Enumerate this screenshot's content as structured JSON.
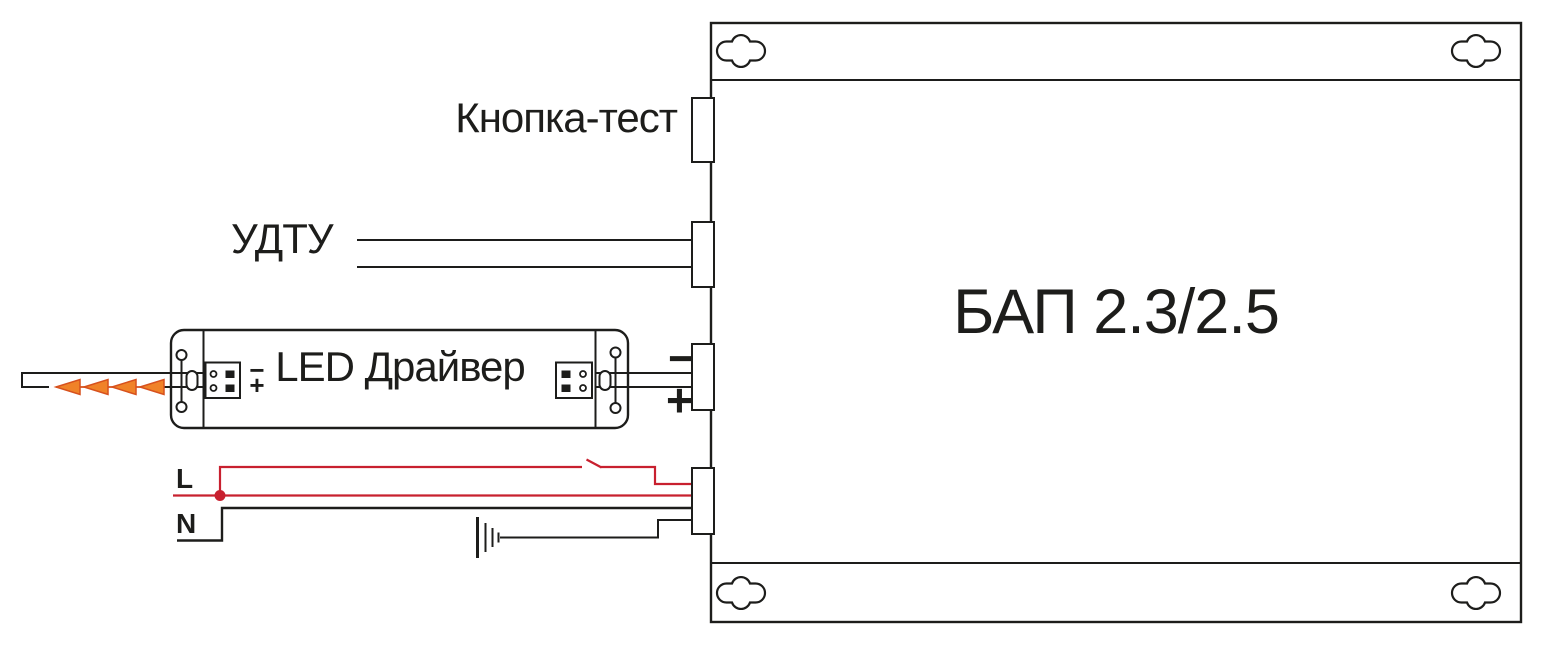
{
  "diagram": {
    "type": "wiring-connection-diagram",
    "unit": {
      "title": "БАП 2.3/2.5"
    },
    "labels": {
      "test_button": "Кнопка-тест",
      "remote_control": "УДТУ",
      "led_driver": "LED Драйвер",
      "line_wire": "L",
      "neutral_wire": "N",
      "output_minus": "−",
      "output_plus": "+",
      "driver_polarity_minus": "−",
      "driver_polarity_plus": "+"
    },
    "colors": {
      "outline": "#1d1d1b",
      "wire_live": "#c8202f",
      "arrow_fill": "#f08228",
      "arrow_stroke": "#d7511d"
    },
    "icons": {
      "mounting_hole_icon": "cross-shaped keyhole slot",
      "earth_ground_icon": "graded vertical bars ground symbol",
      "switch_icon": "open blade contact on live wire",
      "junction_dot_icon": "filled circle wire node",
      "led_direction_arrow_icon": "orange left-pointing triangles"
    }
  }
}
